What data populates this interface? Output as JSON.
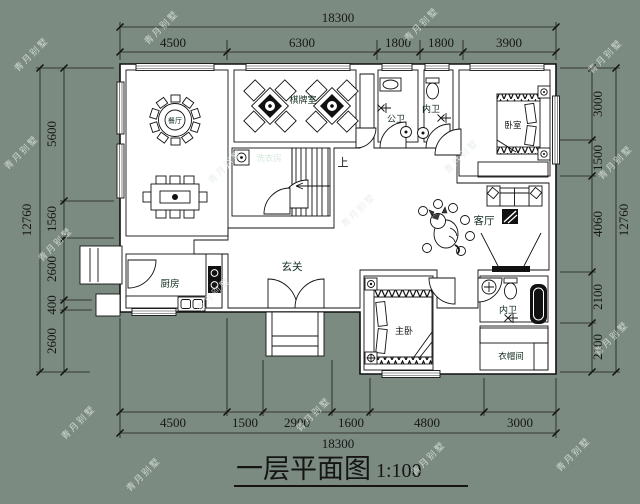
{
  "title": {
    "main": "一层平面图",
    "scale": "1:100"
  },
  "watermark": "青月别墅",
  "colors": {
    "background": "#7b8b81",
    "wall": "#ffffff",
    "outline": "#111111",
    "foyer_living": "#4cc88f",
    "dining": "#c6e7d4",
    "chess_room": "#92d1b2",
    "laundry": "#1a7b4f",
    "kitchen": "#1a7b4f",
    "bedroom_top": "#1f8b59",
    "public_bath": "#a6dec4",
    "inner_bath_top": "#92d1b2",
    "master_bedroom": "#2f9e6a",
    "inner_bath_bottom": "#7fd5ac",
    "cloakroom": "#9edcc1"
  },
  "rooms": {
    "dining": "餐厅",
    "chess": "棋牌室",
    "laundry": "洗衣房",
    "public_bath": "公卫",
    "inner_bath_top": "内卫",
    "bedroom": "卧室",
    "living": "客厅",
    "foyer": "玄关",
    "kitchen": "厨房",
    "master_bedroom": "主卧",
    "inner_bath_bottom": "内卫",
    "cloakroom": "衣帽间",
    "stairs_up": "上"
  },
  "dimensions": {
    "top": {
      "total": "18300",
      "segments": [
        "4500",
        "6300",
        "1800",
        "1800",
        "3900"
      ]
    },
    "bottom": {
      "total": "18300",
      "segments": [
        "4500",
        "1500",
        "2900",
        "1600",
        "4800",
        "3000"
      ]
    },
    "left": {
      "total": "12760",
      "segments": [
        "5600",
        "1560",
        "2600",
        "400",
        "2600"
      ]
    },
    "right": {
      "total": "12760",
      "segments": [
        "3000",
        "1500",
        "4060",
        "2100",
        "2100"
      ]
    }
  }
}
